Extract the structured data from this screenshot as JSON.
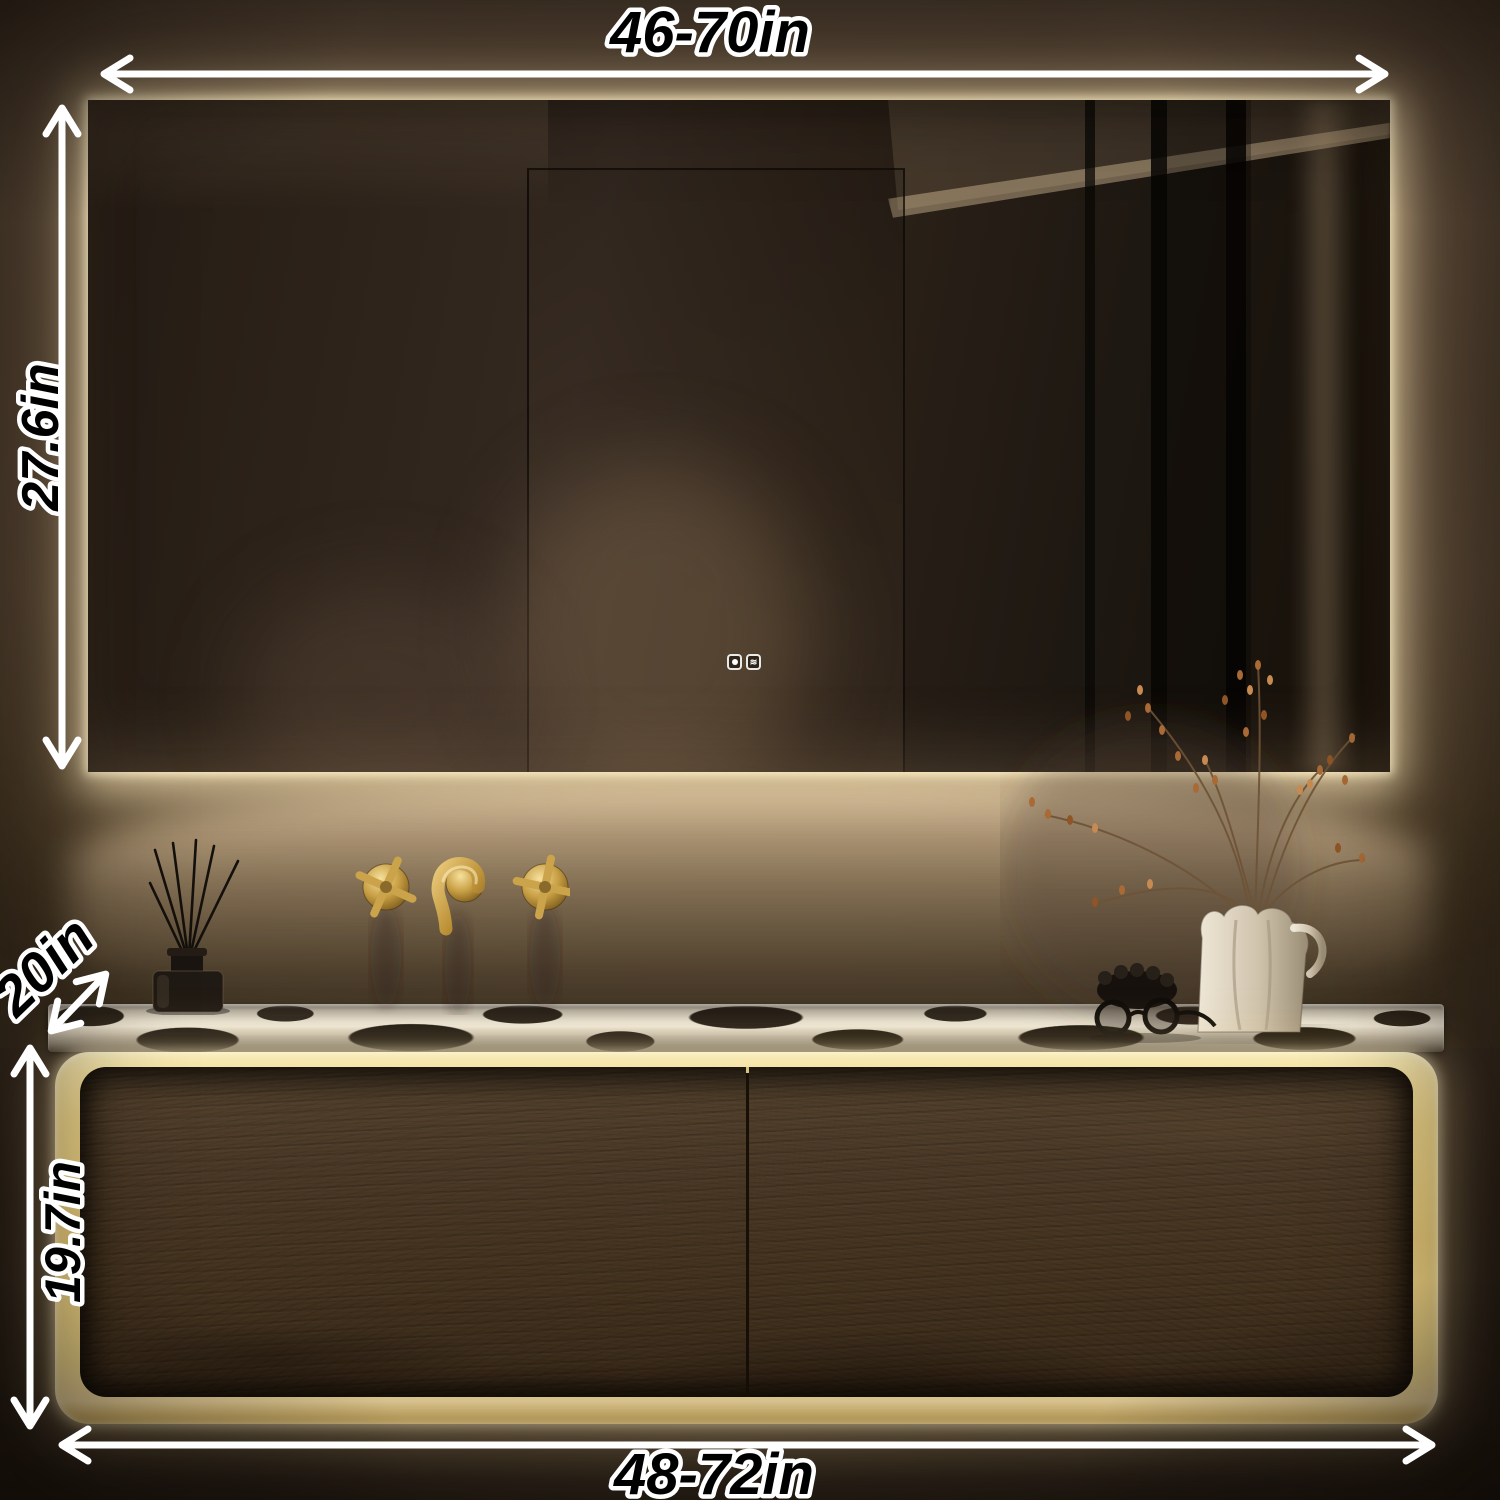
{
  "scene": {
    "title": "Backlit LED bathroom mirror above floating wood vanity with illuminated gold frame",
    "wall_finish": "dark textured stucco",
    "counter_material": "black and white marble"
  },
  "annotations": {
    "mirror_width": {
      "label": "46-70in"
    },
    "mirror_height": {
      "label": "27.6in"
    },
    "counter_depth": {
      "label": "20in"
    },
    "vanity_height": {
      "label": "19.7in"
    },
    "vanity_width": {
      "label": "48-72in"
    }
  },
  "mirror": {
    "touch_buttons": [
      {
        "icon": "light-power-icon"
      },
      {
        "icon": "defog-icon"
      }
    ]
  },
  "colors": {
    "led_glow": "#fff3cf",
    "vanity_frame_gold": "#eed58e",
    "drawer_wood": "#483828",
    "wall_lit": "#b39a7e",
    "wall_dark": "#3a2e22",
    "marble_light": "#ddd6c7",
    "marble_dark": "#1d1812",
    "faucet_brass": "#c9a24a",
    "annotation_fill": "#000000",
    "annotation_stroke": "#ffffff"
  }
}
